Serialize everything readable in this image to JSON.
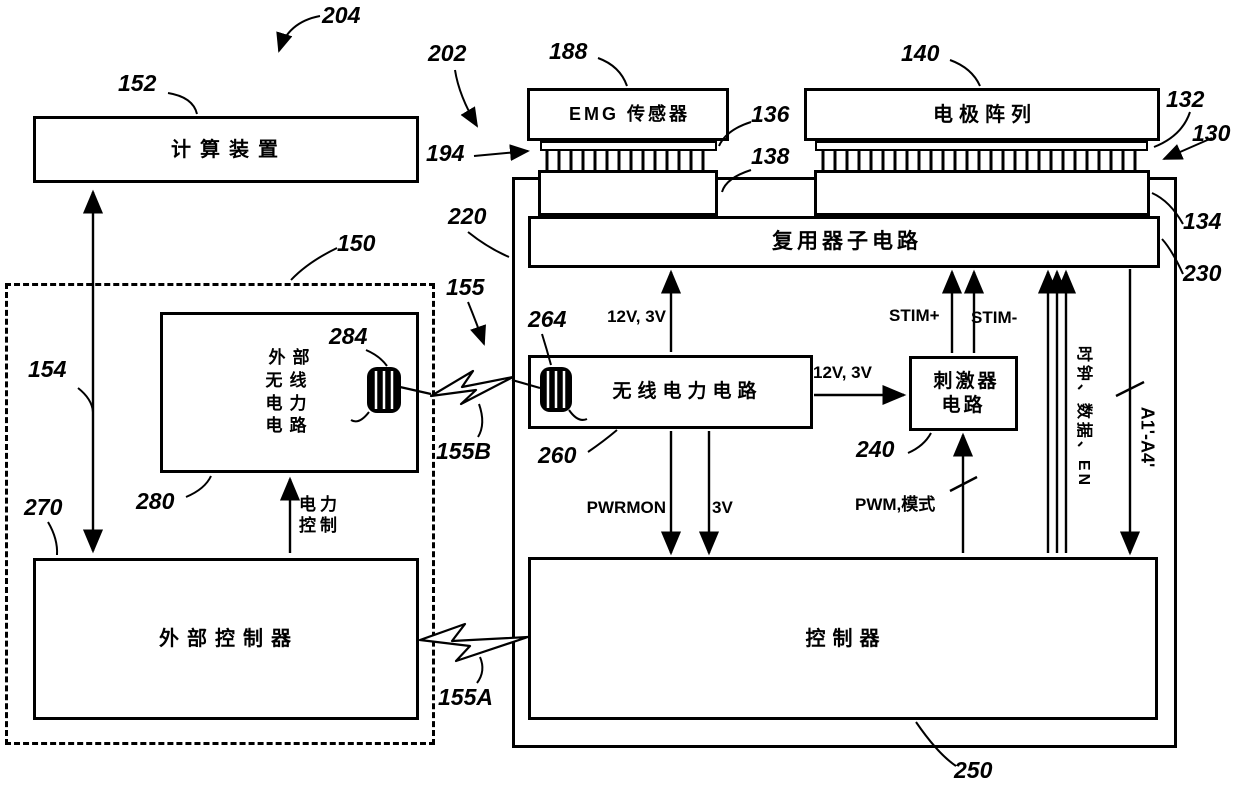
{
  "boxes": {
    "computing_device": "计算装置",
    "emg_sensor": "EMG 传感器",
    "electrode_array": "电极阵列",
    "multiplexer": "复用器子电路",
    "external_wireless_power": "外部\n无线\n电力\n电路",
    "wireless_power": "无线电力电路",
    "stimulator": "刺激器\n电路",
    "external_controller": "外部控制器",
    "controller": "控制器"
  },
  "signals": {
    "supply_up": "12V, 3V",
    "supply_stim": "12V, 3V",
    "stim_plus": "STIM+",
    "stim_minus": "STIM-",
    "pwrmon": "PWRMON",
    "v3": "3V",
    "pwm_mode": "PWM,模式",
    "power_control": "电力\n控制",
    "clock_data_en": "时钟、数据、EN",
    "a1_a4": "A1'-A4'"
  },
  "refs": {
    "204": "204",
    "202": "202",
    "152": "152",
    "188": "188",
    "140": "140",
    "132": "132",
    "130": "130",
    "194": "194",
    "136": "136",
    "138": "138",
    "220": "220",
    "134": "134",
    "230": "230",
    "150": "150",
    "155": "155",
    "154": "154",
    "264": "264",
    "284": "284",
    "155B": "155B",
    "260": "260",
    "240": "240",
    "280": "280",
    "270": "270",
    "155A": "155A",
    "250": "250"
  },
  "colors": {
    "line": "#000000",
    "background": "#ffffff"
  }
}
